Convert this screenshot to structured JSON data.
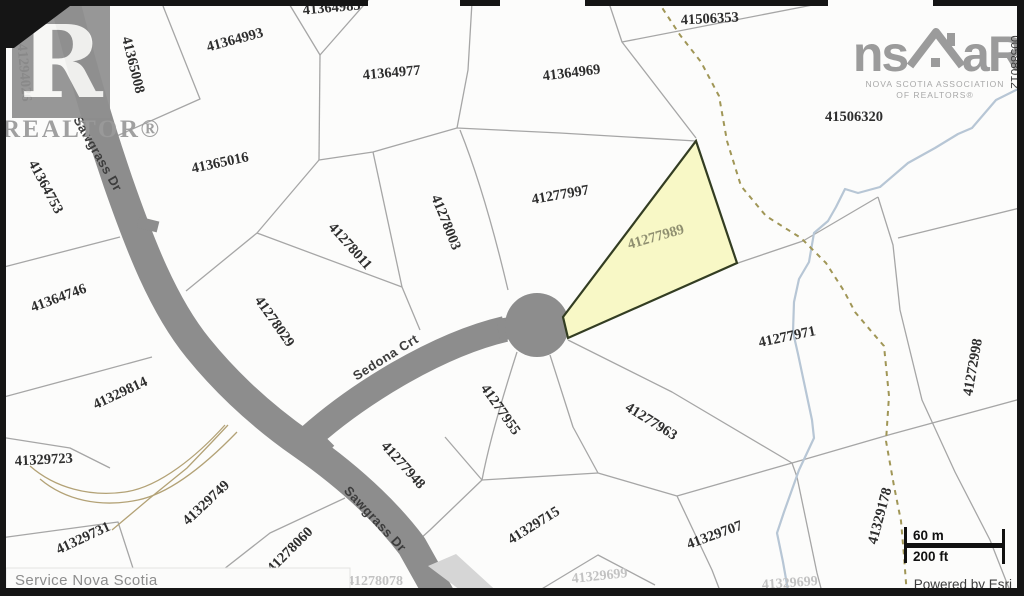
{
  "colors": {
    "road": "#8d8d8d",
    "parcel_line": "#a6a6a6",
    "stream": "#b7c6d5",
    "trail": "#a09656",
    "contour": "#b3a276",
    "highlight_fill": "#f8f8c6",
    "highlight_outline": "#333d22",
    "highlight_label": "#8f8f70",
    "label": "#2e2e2e",
    "faded_label": "#c2c2c2",
    "border": "#151515",
    "logo_gray": "#9b9b9b"
  },
  "branding": {
    "realtor_letter": "R",
    "realtor_wordmark": "REALTOR®",
    "nsar_left": "ns",
    "nsar_right": "aR",
    "nsar_tagline_line1": "NOVA SCOTIA ASSOCIATION",
    "nsar_tagline_line2": "OF REALTORS®"
  },
  "edge_code": "00588012",
  "attribution": {
    "left": "Service Nova Scotia",
    "right_prefix": "Powered by ",
    "right_brand": "Esri"
  },
  "scale_bar": {
    "metric": "60 m",
    "imperial": "200 ft"
  },
  "highlight": {
    "pid": "41277989",
    "x": 657,
    "y": 241,
    "rot": -16
  },
  "road_labels": [
    {
      "label": "Sawgrass Dr",
      "x": 94,
      "y": 156,
      "rot": 60
    },
    {
      "label": "Sedona Crt",
      "x": 388,
      "y": 361,
      "rot": -32
    },
    {
      "label": "Sawgrass Dr",
      "x": 372,
      "y": 522,
      "rot": 47
    }
  ],
  "parcels": [
    {
      "pid": "41294026",
      "x": 20,
      "y": 73,
      "rot": 85
    },
    {
      "pid": "41365008",
      "x": 129,
      "y": 66,
      "rot": 76
    },
    {
      "pid": "41364993",
      "x": 236,
      "y": 44,
      "rot": -15
    },
    {
      "pid": "41364985",
      "x": 332,
      "y": 12,
      "rot": -5
    },
    {
      "pid": "41364977",
      "x": 392,
      "y": 77,
      "rot": -5
    },
    {
      "pid": "41364969",
      "x": 572,
      "y": 77,
      "rot": -7
    },
    {
      "pid": "41506353",
      "x": 710,
      "y": 23,
      "rot": -3
    },
    {
      "pid": "41506320",
      "x": 854,
      "y": 121,
      "rot": 0
    },
    {
      "pid": "41364753",
      "x": 42,
      "y": 189,
      "rot": 62
    },
    {
      "pid": "41365016",
      "x": 221,
      "y": 167,
      "rot": -12
    },
    {
      "pid": "41277997",
      "x": 561,
      "y": 199,
      "rot": -10
    },
    {
      "pid": "41278003",
      "x": 442,
      "y": 224,
      "rot": 68
    },
    {
      "pid": "41278011",
      "x": 347,
      "y": 249,
      "rot": 48
    },
    {
      "pid": "41364746",
      "x": 60,
      "y": 302,
      "rot": -20
    },
    {
      "pid": "41278029",
      "x": 271,
      "y": 324,
      "rot": 55
    },
    {
      "pid": "41277971",
      "x": 788,
      "y": 341,
      "rot": -12
    },
    {
      "pid": "41272998",
      "x": 977,
      "y": 368,
      "rot": -80
    },
    {
      "pid": "41329814",
      "x": 122,
      "y": 397,
      "rot": -25
    },
    {
      "pid": "41277955",
      "x": 497,
      "y": 412,
      "rot": 55
    },
    {
      "pid": "41277963",
      "x": 649,
      "y": 425,
      "rot": 32
    },
    {
      "pid": "41329723",
      "x": 44,
      "y": 464,
      "rot": -3
    },
    {
      "pid": "41277948",
      "x": 400,
      "y": 468,
      "rot": 48
    },
    {
      "pid": "41329749",
      "x": 209,
      "y": 506,
      "rot": -43
    },
    {
      "pid": "41329731",
      "x": 85,
      "y": 542,
      "rot": -25
    },
    {
      "pid": "41278060",
      "x": 293,
      "y": 553,
      "rot": -45
    },
    {
      "pid": "41329715",
      "x": 536,
      "y": 529,
      "rot": -32
    },
    {
      "pid": "41329707",
      "x": 716,
      "y": 539,
      "rot": -20
    },
    {
      "pid": "41329178",
      "x": 884,
      "y": 517,
      "rot": -75
    },
    {
      "pid": "41278078",
      "x": 375,
      "y": 585,
      "rot": 0,
      "faded": true
    },
    {
      "pid": "41329699",
      "x": 600,
      "y": 580,
      "rot": -6,
      "faded": true
    },
    {
      "pid": "41329699",
      "x": 790,
      "y": 587,
      "rot": -4,
      "faded": true
    }
  ]
}
